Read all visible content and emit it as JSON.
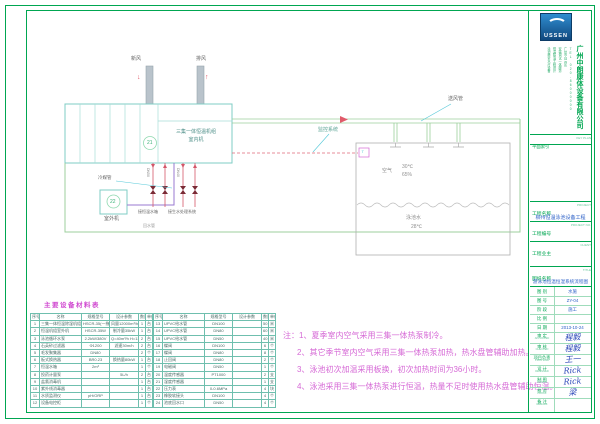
{
  "colors": {
    "frame_green": "#00a651",
    "pipe_green": "#9ccf9c",
    "equip_cyan": "#7fccc4",
    "line_red": "#e05a6a",
    "line_purple": "#9a7ad0",
    "note_pink": "#d66ad6",
    "value_blue": "#2e62c8",
    "logo_blue": "#2f8dd0"
  },
  "logo": {
    "text": "USSEN"
  },
  "company": {
    "name": "广州中朗康体设备有限公司",
    "lines": [
      "泳池桑拿水疗设备",
      "恒温除湿工程设计",
      "安装调试一体服务",
      "广州市白云区",
      "TEL 020-86000000"
    ]
  },
  "titleblock": {
    "key_plan": {
      "label": "平面索引",
      "en": "KEY PLAN"
    },
    "fields": [
      {
        "label": "工程名称",
        "en": "PROJECT",
        "value": "柳州恒温泳池设备工程"
      },
      {
        "label": "工程编号",
        "en": "PROJECT NO.",
        "value": ""
      },
      {
        "label": "工程业主",
        "en": "CLIENT",
        "value": ""
      },
      {
        "label": "图纸名称",
        "en": "TITLE",
        "value": "游泳池恒温恒湿系统流程图"
      }
    ],
    "info": [
      {
        "label": "图 别",
        "value": "水施"
      },
      {
        "label": "图 号",
        "value": "ZY-04"
      },
      {
        "label": "阶 段",
        "value": "施工"
      },
      {
        "label": "比 例",
        "value": ""
      },
      {
        "label": "日 期",
        "value": "2013-10-24"
      }
    ],
    "signatures": [
      {
        "label": "审 定",
        "en": "APPROVED",
        "value": "程毅"
      },
      {
        "label": "审 核",
        "en": "CHECKED",
        "value": "程毅"
      },
      {
        "label": "项目负责",
        "en": "PROJ MGR",
        "value": "王一"
      },
      {
        "label": "设 计",
        "en": "DESIGNED",
        "value": "Rick"
      },
      {
        "label": "制 图",
        "en": "DRAWN",
        "value": "Rick"
      },
      {
        "label": "校 对",
        "en": "PROOF",
        "value": "梁"
      }
    ],
    "remark": {
      "label": "备 注",
      "en": "REMARK",
      "value": ""
    }
  },
  "diagram": {
    "fresh_air": "新风",
    "exhaust_air": "排风",
    "unit_name": "三集一体恒温机组",
    "unit_sub": "室内机",
    "tag_indoor": "21",
    "tag_outdoor": "22",
    "outdoor_unit": "室外机",
    "refrigerant_pipe": "冷媒管",
    "pipe_tag_a": "DN50",
    "pipe_tag_b": "DN40",
    "to_pool_tank": "接恒温水箱",
    "to_water_treatment": "接生水处理系统",
    "monitor_system": "监控系统",
    "supply_duct": "送风管",
    "return_pipe": "回水管",
    "air": "空气",
    "air_temp": "30℃",
    "air_rh": "65%",
    "pool_water": "泳池水",
    "pool_temp": "28℃",
    "sensor": "T",
    "down_arrow": "↓",
    "up_arrow": "↑"
  },
  "equipment_table": {
    "title": "主要设备材料表",
    "headers": [
      "序号",
      "名称",
      "规格型号",
      "设计参数",
      "数量",
      "单位"
    ],
    "left_rows": [
      [
        "1",
        "三集一体恒温除湿机组",
        "HSCR-35(一拖一·室内机)",
        "风量12000m³/h",
        "1",
        "台"
      ],
      [
        "2",
        "恒温机组室外机",
        "HSCR-35W",
        "制冷量35kW",
        "1",
        "台"
      ],
      [
        "3",
        "泳池循环水泵",
        "2.2kW/380V",
        "Q=40m³/h H=13m",
        "2",
        "台"
      ],
      [
        "4",
        "石英砂过滤器",
        "Φ1200",
        "滤速30m/h",
        "2",
        "台"
      ],
      [
        "5",
        "毛发聚集器",
        "DN80",
        "",
        "2",
        "个"
      ],
      [
        "6",
        "板式换热器",
        "BR0.23",
        "换热量80kW",
        "1",
        "台"
      ],
      [
        "7",
        "恒温水箱",
        "2m³",
        "",
        "1",
        "个"
      ],
      [
        "8",
        "投药计量泵",
        "",
        "5L/h",
        "2",
        "台"
      ],
      [
        "9",
        "盐氯消毒机",
        "",
        "",
        "1",
        "台"
      ],
      [
        "10",
        "紫外线消毒器",
        "",
        "",
        "1",
        "台"
      ],
      [
        "11",
        "水质监测仪",
        "pH/ORP",
        "",
        "1",
        "台"
      ],
      [
        "12",
        "设备电控柜",
        "",
        "",
        "1",
        "个"
      ]
    ],
    "right_rows": [
      [
        "13",
        "UPVC给水管",
        "DN100",
        "",
        "50",
        "米"
      ],
      [
        "14",
        "UPVC给水管",
        "DN80",
        "",
        "60",
        "米"
      ],
      [
        "15",
        "UPVC给水管",
        "DN50",
        "",
        "40",
        "米"
      ],
      [
        "16",
        "蝶阀",
        "DN100",
        "",
        "6",
        "个"
      ],
      [
        "17",
        "蝶阀",
        "DN80",
        "",
        "8",
        "个"
      ],
      [
        "18",
        "止回阀",
        "DN80",
        "",
        "2",
        "个"
      ],
      [
        "19",
        "电磁阀",
        "DN50",
        "",
        "1",
        "个"
      ],
      [
        "20",
        "温度传感器",
        "PT1000",
        "",
        "2",
        "支"
      ],
      [
        "21",
        "湿度传感器",
        "",
        "",
        "1",
        "支"
      ],
      [
        "22",
        "压力表",
        "0-0.6MPa",
        "",
        "4",
        "块"
      ],
      [
        "23",
        "橡胶软接头",
        "DN100",
        "",
        "4",
        "个"
      ],
      [
        "24",
        "池底回水口",
        "DN50",
        "",
        "4",
        "个"
      ]
    ]
  },
  "notes": {
    "lines": [
      "注：1、夏季室内空气采用三集一体热泵制冷。",
      "2、其它季节室内空气采用三集一体热泵加热，热水盘管辅助加热。",
      "3、泳池初次加温采用板换，初次加热时间为36小时。",
      "4、泳池采用三集一体热泵进行恒温，热量不足时使用热水盘管辅助恒温。"
    ]
  }
}
